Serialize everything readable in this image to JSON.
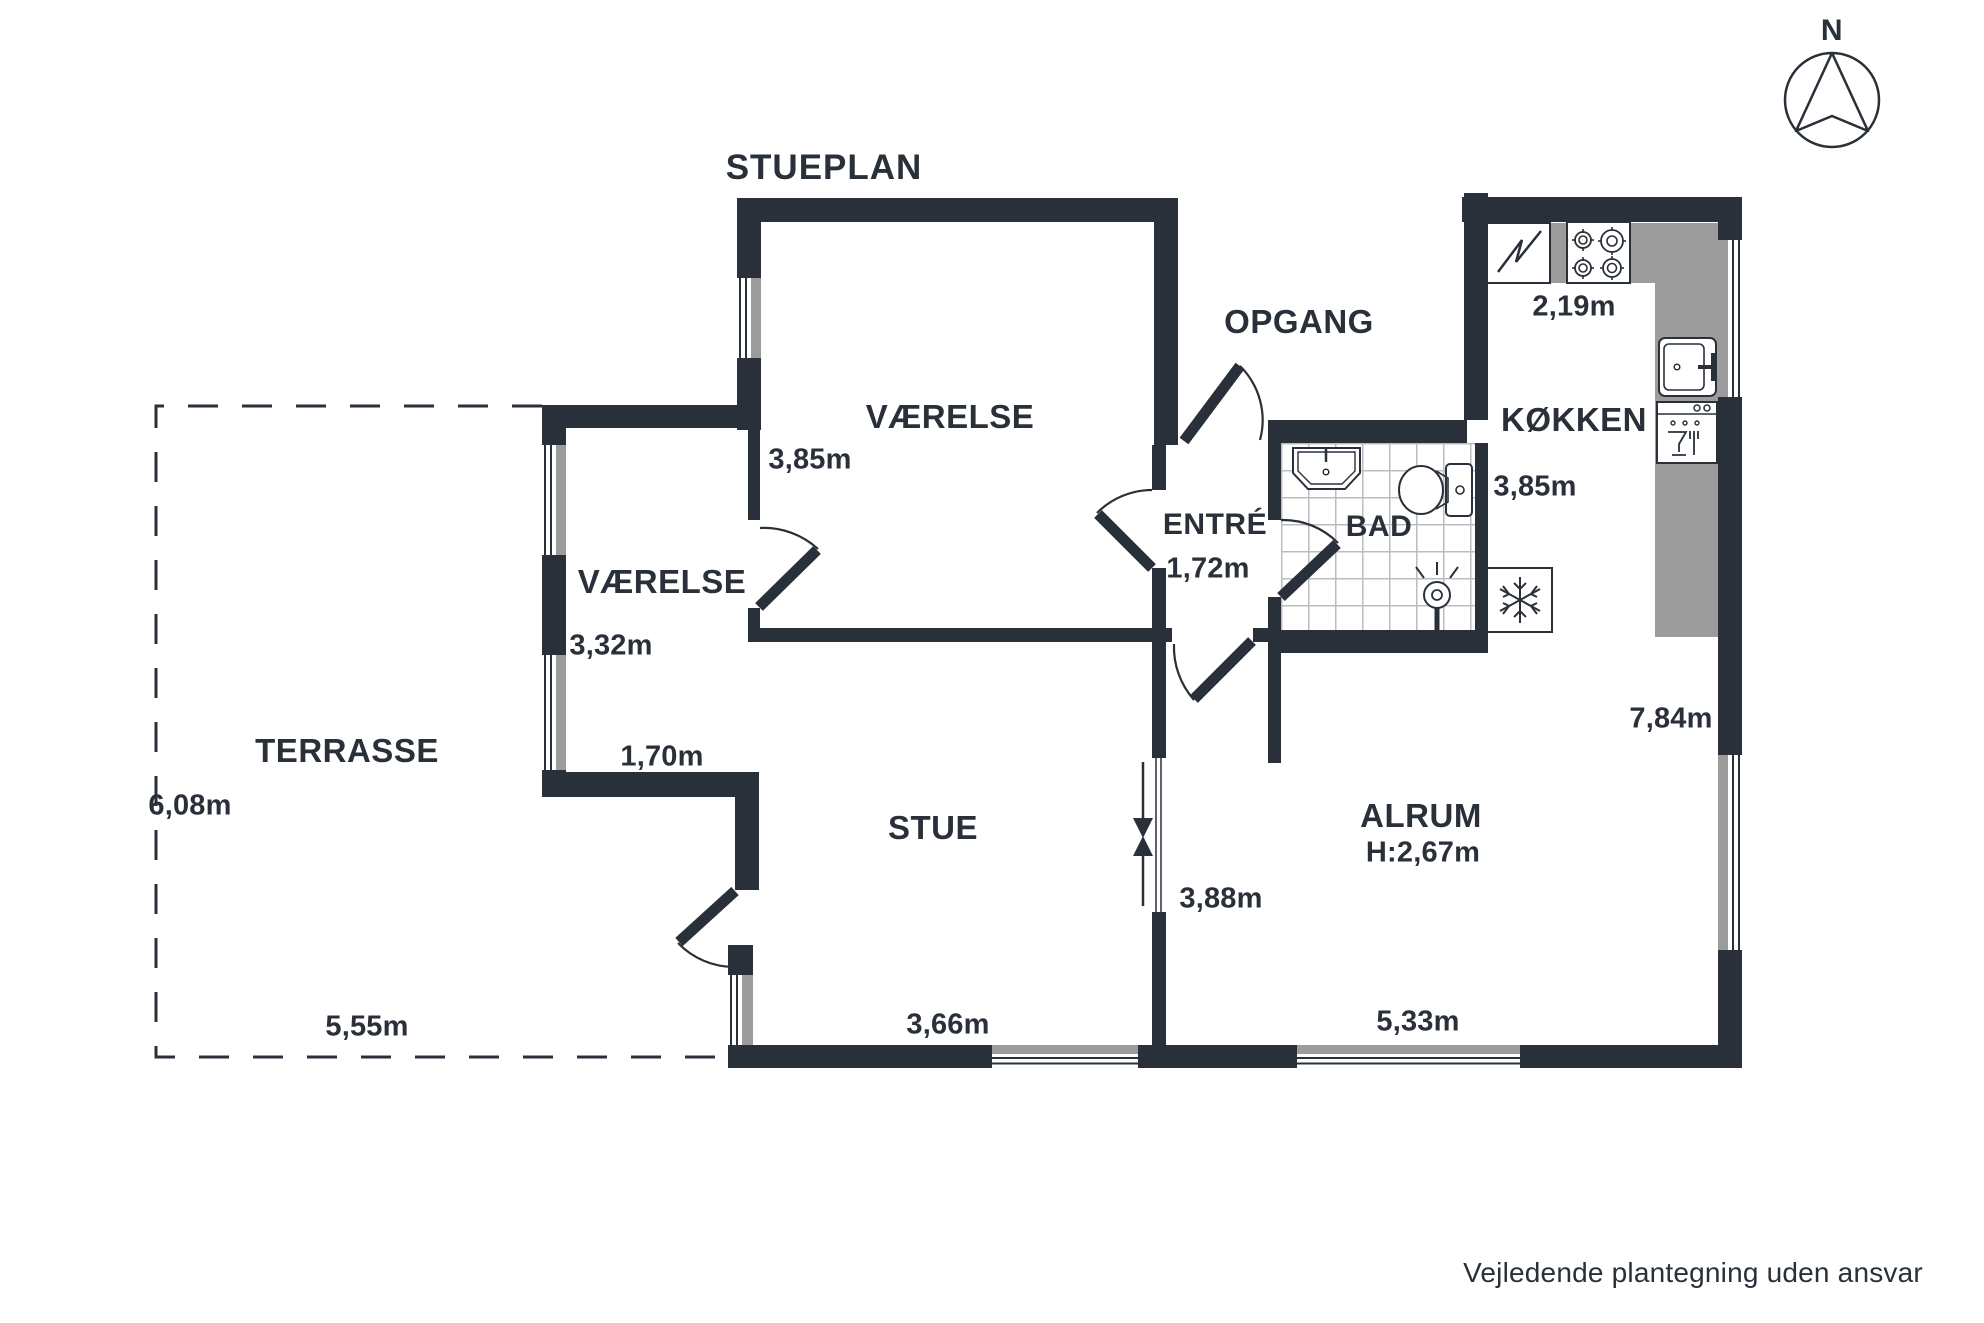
{
  "title": "STUEPLAN",
  "compass": {
    "north_label": "N"
  },
  "disclaimer": "Vejledende plantegning uden ansvar",
  "rooms": {
    "vaerelse_top": {
      "label": "VÆRELSE",
      "depth": "3,85m"
    },
    "vaerelse_small": {
      "label": "VÆRELSE",
      "depth": "3,32m",
      "width": "1,70m"
    },
    "stue": {
      "label": "STUE",
      "width": "3,66m"
    },
    "entre": {
      "label": "ENTRÉ",
      "width": "1,72m"
    },
    "opgang": {
      "label": "OPGANG"
    },
    "bad": {
      "label": "BAD"
    },
    "kokken": {
      "label": "KØKKEN",
      "width": "2,19m",
      "depth": "3,85m"
    },
    "alrum": {
      "label": "ALRUM",
      "ceiling_height": "H:2,67m",
      "width": "5,33m",
      "right_depth": "7,84m",
      "opening_width": "3,88m"
    },
    "terrasse": {
      "label": "TERRASSE",
      "depth": "6,08m",
      "width": "5,55m"
    }
  },
  "icons": [
    "compass-north",
    "stove-cooktop",
    "kitchen-sink",
    "dishwasher",
    "refrigerator-snowflake",
    "washbasin",
    "toilet",
    "shower",
    "appliance-zigzag",
    "door-swing",
    "opening-arrows"
  ],
  "colors": {
    "wall": "#2A3039",
    "counter": "#9C9C9C",
    "tile_line": "#b9bdc0"
  }
}
